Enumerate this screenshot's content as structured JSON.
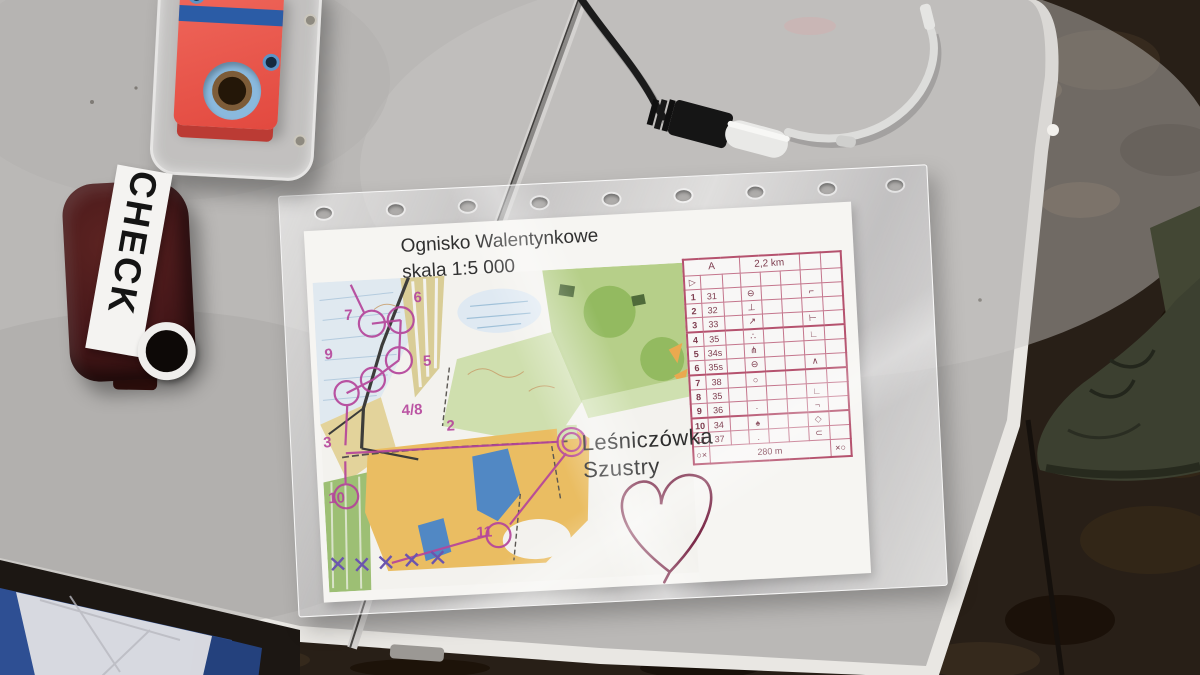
{
  "check_station": {
    "label": "CHECK"
  },
  "map_sheet": {
    "title": "Ognisko Walentynkowe",
    "scale": "skala 1:5 000",
    "location": {
      "line1": "Leśniczówka",
      "line2": "Szustry"
    },
    "course_numbers": [
      {
        "text": "7"
      },
      {
        "text": "6"
      },
      {
        "text": "9"
      },
      {
        "text": "5"
      },
      {
        "text": "4/8"
      },
      {
        "text": "3"
      },
      {
        "text": "2"
      },
      {
        "text": "10"
      },
      {
        "text": "11"
      }
    ],
    "control_table": {
      "course": "A",
      "length": "2,2 km",
      "start_symbol": "▷",
      "rows": [
        {
          "num": "1",
          "code": "31",
          "sym1": "⊖",
          "sym2": "⌐"
        },
        {
          "num": "2",
          "code": "32",
          "sym1": "⊥",
          "sym2": ""
        },
        {
          "num": "3",
          "code": "33",
          "sym1": "↗",
          "sym2": "⊢"
        },
        {
          "num": "4",
          "code": "35",
          "sym1": "∴",
          "sym2": "∟"
        },
        {
          "num": "5",
          "code": "34s",
          "sym1": "⋔",
          "sym2": ""
        },
        {
          "num": "6",
          "code": "35s",
          "sym1": "⊖",
          "sym2": "∧"
        },
        {
          "num": "7",
          "code": "38",
          "sym1": "○",
          "sym2": ""
        },
        {
          "num": "8",
          "code": "35",
          "sym1": "",
          "sym2": "∟"
        },
        {
          "num": "9",
          "code": "36",
          "sym1": "·",
          "sym2": "¬"
        },
        {
          "num": "10",
          "code": "34",
          "sym1": "♠",
          "sym2": "◇"
        },
        {
          "num": "11",
          "code": "37",
          "sym1": ".",
          "sym2": "⊂"
        }
      ],
      "finish_left": "○×",
      "finish_distance": "280 m",
      "finish_right": "×○"
    }
  },
  "colors": {
    "course_purple": "#b5459b",
    "control_card_pink": "#b5526e",
    "table_gray": "#bab8b6",
    "si_station_red": "#e8554b",
    "si_stripe_blue": "#2b5ca6",
    "check_body_maroon": "#47181a",
    "crate_blue": "#2e4f93",
    "ground_brown": "#281f17",
    "map_green": "#b6cf89",
    "map_open_orange": "#eabd62",
    "map_water_blue": "#5188c4"
  }
}
